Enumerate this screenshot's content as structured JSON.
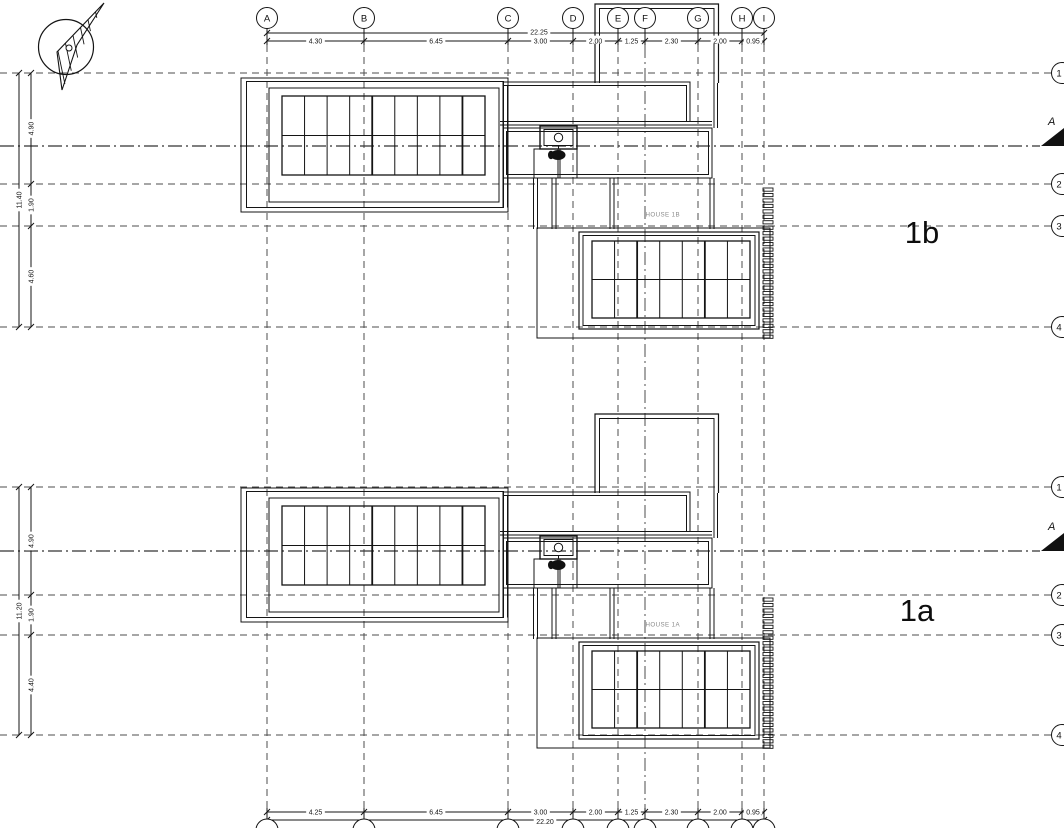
{
  "grid": {
    "columns": [
      "A",
      "B",
      "C",
      "D",
      "E",
      "F",
      "G",
      "H",
      "I"
    ],
    "rows": [
      "1",
      "2",
      "3",
      "4"
    ]
  },
  "dimensions": {
    "top": {
      "total": "22.25",
      "segments": [
        "4.30",
        "6.45",
        "3.00",
        "2.00",
        "1.25",
        "2.30",
        "2.00",
        "0.95"
      ]
    },
    "bottom": {
      "total": "22.20",
      "segments": [
        "4.25",
        "6.45",
        "3.00",
        "2.00",
        "1.25",
        "2.30",
        "2.00",
        "0.95"
      ]
    },
    "left_house_1b": {
      "total": "11.40",
      "segments": [
        "4.90",
        "1.90",
        "4.60"
      ]
    },
    "left_house_1a": {
      "total": "11.20",
      "segments": [
        "4.90",
        "1.90",
        "4.40"
      ]
    }
  },
  "houses": [
    {
      "id": "1b",
      "label": "1b",
      "plan_label": "HOUSE 1B"
    },
    {
      "id": "1a",
      "label": "1a",
      "plan_label": "HOUSE 1A"
    }
  ],
  "section_markers": [
    {
      "label": "A"
    },
    {
      "label": "A"
    }
  ],
  "icons": {
    "north_arrow": "north-arrow-icon"
  },
  "colors": {
    "line": "#141414",
    "grid_line": "#4d4d4d",
    "muted_text": "#8a8a8a",
    "background": "#ffffff"
  }
}
